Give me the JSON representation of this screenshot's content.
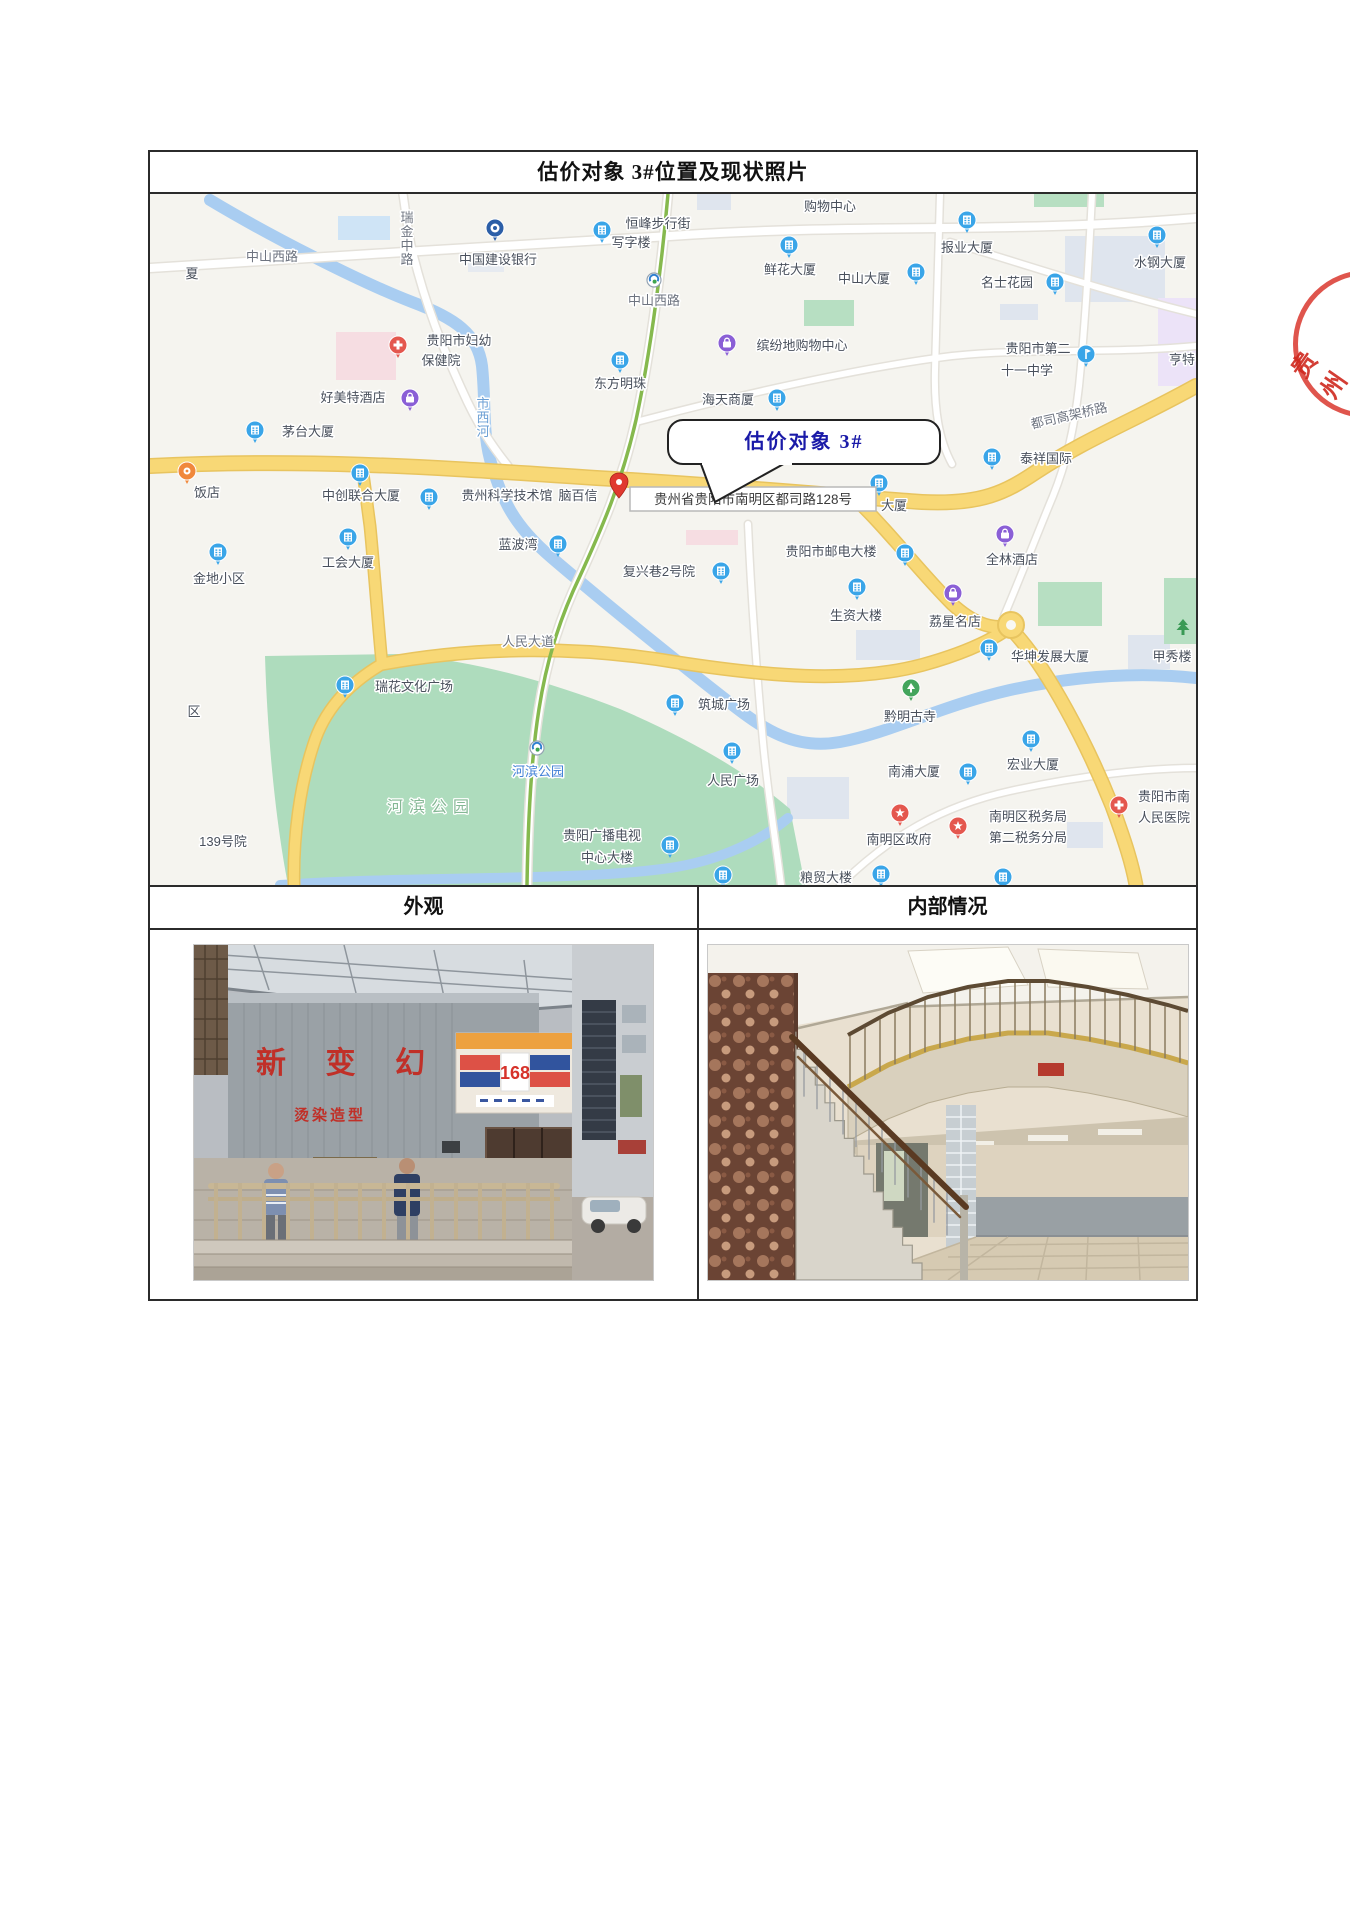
{
  "table": {
    "title": "估价对象 3#位置及现状照片",
    "left_header": "外观",
    "right_header": "内部情况"
  },
  "map": {
    "callout_text": "估价对象 3#",
    "address_tooltip": "贵州省贵阳市南明区都司路128号",
    "road_labels": [
      {
        "t": "中山西路",
        "x": 122,
        "y": 67,
        "cls": "road"
      },
      {
        "t": "瑞金中路",
        "x": 257,
        "y": 14,
        "cls": "road",
        "vertical": true
      },
      {
        "t": "市西河",
        "x": 333,
        "y": 200,
        "cls": "river",
        "vertical": true
      },
      {
        "t": "人民大道",
        "x": 378,
        "y": 452,
        "cls": "road"
      },
      {
        "t": "都司高架桥路",
        "x": 920,
        "y": 226,
        "cls": "road",
        "rot": -13
      },
      {
        "t": "河滨公园",
        "x": 281,
        "y": 618,
        "cls": "park"
      }
    ],
    "pois": [
      {
        "type": "bank",
        "ix": 345,
        "iy": 34,
        "lines": [
          {
            "t": "中国建设银行",
            "x": 348,
            "y": 70
          }
        ]
      },
      {
        "type": "building",
        "ix": 452,
        "iy": 36,
        "lines": [
          {
            "t": "恒峰步行街",
            "x": 508,
            "y": 34
          },
          {
            "t": "写字楼",
            "x": 481,
            "y": 53
          }
        ]
      },
      {
        "type": "none",
        "lines": [
          {
            "t": "购物中心",
            "x": 680,
            "y": 17
          }
        ]
      },
      {
        "type": "building",
        "ix": 639,
        "iy": 51,
        "lines": [
          {
            "t": "鲜花大厦",
            "x": 640,
            "y": 80
          }
        ]
      },
      {
        "type": "building",
        "ix": 817,
        "iy": 26,
        "lines": [
          {
            "t": "报业大厦",
            "x": 817,
            "y": 58
          }
        ]
      },
      {
        "type": "building",
        "ix": 1007,
        "iy": 41,
        "lines": [
          {
            "t": "水钢大厦",
            "x": 1010,
            "y": 73
          }
        ]
      },
      {
        "type": "building",
        "ix": 766,
        "iy": 78,
        "lines": [
          {
            "t": "中山大厦",
            "x": 714,
            "y": 89
          }
        ]
      },
      {
        "type": "building",
        "ix": 905,
        "iy": 88,
        "lines": [
          {
            "t": "名士花园",
            "x": 857,
            "y": 93
          }
        ]
      },
      {
        "type": "shopping",
        "ix": 577,
        "iy": 149,
        "lines": [
          {
            "t": "缤纷地购物中心",
            "x": 652,
            "y": 156
          }
        ]
      },
      {
        "type": "school",
        "ix": 936,
        "iy": 160,
        "lines": [
          {
            "t": "贵阳市第二",
            "x": 888,
            "y": 159
          },
          {
            "t": "十一中学",
            "x": 877,
            "y": 181
          }
        ]
      },
      {
        "type": "none",
        "lines": [
          {
            "t": "亨特",
            "x": 1032,
            "y": 170
          }
        ]
      },
      {
        "type": "building",
        "ix": 470,
        "iy": 166,
        "lines": [
          {
            "t": "东方明珠",
            "x": 470,
            "y": 194
          }
        ]
      },
      {
        "type": "hospital",
        "ix": 248,
        "iy": 151,
        "lines": [
          {
            "t": "贵阳市妇幼",
            "x": 309,
            "y": 151
          },
          {
            "t": "保健院",
            "x": 291,
            "y": 171
          }
        ]
      },
      {
        "type": "hotel",
        "ix": 260,
        "iy": 204,
        "lines": [
          {
            "t": "好美特酒店",
            "x": 203,
            "y": 208
          }
        ]
      },
      {
        "type": "building",
        "ix": 105,
        "iy": 236,
        "lines": [
          {
            "t": "茅台大厦",
            "x": 158,
            "y": 242
          }
        ]
      },
      {
        "type": "building",
        "ix": 627,
        "iy": 204,
        "lines": [
          {
            "t": "海天商厦",
            "x": 578,
            "y": 210
          }
        ]
      },
      {
        "type": "restaurant",
        "ix": 37,
        "iy": 277,
        "lines": [
          {
            "t": "饭店",
            "x": 57,
            "y": 303
          }
        ]
      },
      {
        "type": "building",
        "ix": 210,
        "iy": 279,
        "lines": [
          {
            "t": "中创联合大厦",
            "x": 211,
            "y": 306
          }
        ]
      },
      {
        "type": "building",
        "ix": 279,
        "iy": 303,
        "lines": [
          {
            "t": "贵州科学技术馆",
            "x": 357,
            "y": 306
          }
        ]
      },
      {
        "type": "none",
        "lines": [
          {
            "t": "脑百信",
            "x": 428,
            "y": 306
          }
        ]
      },
      {
        "type": "building",
        "ix": 729,
        "iy": 289,
        "lines": [
          {
            "t": "大厦",
            "x": 744,
            "y": 316
          }
        ]
      },
      {
        "type": "building",
        "ix": 842,
        "iy": 263,
        "lines": [
          {
            "t": "泰祥国际",
            "x": 896,
            "y": 269
          }
        ]
      },
      {
        "type": "building",
        "ix": 408,
        "iy": 350,
        "lines": [
          {
            "t": "蓝波湾",
            "x": 368,
            "y": 355
          }
        ]
      },
      {
        "type": "building",
        "ix": 198,
        "iy": 343,
        "lines": [
          {
            "t": "工会大厦",
            "x": 198,
            "y": 373
          }
        ]
      },
      {
        "type": "building",
        "ix": 68,
        "iy": 358,
        "lines": [
          {
            "t": "金地小区",
            "x": 69,
            "y": 389
          }
        ]
      },
      {
        "type": "building",
        "ix": 571,
        "iy": 377,
        "lines": [
          {
            "t": "复兴巷2号院",
            "x": 509,
            "y": 382
          }
        ]
      },
      {
        "type": "building",
        "ix": 755,
        "iy": 359,
        "lines": [
          {
            "t": "贵阳市邮电大楼",
            "x": 681,
            "y": 362
          }
        ]
      },
      {
        "type": "hotel",
        "ix": 855,
        "iy": 340,
        "lines": [
          {
            "t": "全林酒店",
            "x": 862,
            "y": 370
          }
        ]
      },
      {
        "type": "building",
        "ix": 707,
        "iy": 393,
        "lines": [
          {
            "t": "生资大楼",
            "x": 706,
            "y": 426
          }
        ]
      },
      {
        "type": "shopping",
        "ix": 803,
        "iy": 399,
        "lines": [
          {
            "t": "荔星名店",
            "x": 805,
            "y": 432
          }
        ]
      },
      {
        "type": "building",
        "ix": 839,
        "iy": 454,
        "lines": [
          {
            "t": "华坤发展大厦",
            "x": 900,
            "y": 467
          }
        ]
      },
      {
        "type": "landmark",
        "ix": 1033,
        "iy": 434,
        "lines": [
          {
            "t": "甲秀楼",
            "x": 1022,
            "y": 467,
            "anchor": "start"
          }
        ]
      },
      {
        "type": "building",
        "ix": 195,
        "iy": 491,
        "lines": [
          {
            "t": "瑞花文化广场",
            "x": 264,
            "y": 497
          }
        ]
      },
      {
        "type": "temple",
        "ix": 761,
        "iy": 494,
        "lines": [
          {
            "t": "黔明古寺",
            "x": 760,
            "y": 527
          }
        ]
      },
      {
        "type": "building",
        "ix": 525,
        "iy": 509,
        "lines": [
          {
            "t": "筑城广场",
            "x": 574,
            "y": 515
          }
        ]
      },
      {
        "type": "building",
        "ix": 582,
        "iy": 557,
        "lines": [
          {
            "t": "人民广场",
            "x": 583,
            "y": 591
          }
        ]
      },
      {
        "type": "metro",
        "ix": 387,
        "iy": 554,
        "lines": [
          {
            "t": "河滨公园",
            "x": 388,
            "y": 582,
            "cls": "station"
          }
        ]
      },
      {
        "type": "metro",
        "ix": 504,
        "iy": 86,
        "lines": [
          {
            "t": "中山西路",
            "x": 504,
            "y": 111,
            "cls": "road"
          }
        ]
      },
      {
        "type": "building",
        "ix": 818,
        "iy": 578,
        "lines": [
          {
            "t": "南浦大厦",
            "x": 764,
            "y": 582
          }
        ]
      },
      {
        "type": "building",
        "ix": 881,
        "iy": 545,
        "lines": [
          {
            "t": "宏业大厦",
            "x": 883,
            "y": 575
          }
        ]
      },
      {
        "type": "building",
        "ix": 520,
        "iy": 651,
        "lines": [
          {
            "t": "贵阳广播电视",
            "x": 452,
            "y": 646
          },
          {
            "t": "中心大楼",
            "x": 457,
            "y": 668
          }
        ]
      },
      {
        "type": "government",
        "ix": 750,
        "iy": 619,
        "lines": [
          {
            "t": "南明区政府",
            "x": 749,
            "y": 650
          }
        ]
      },
      {
        "type": "government",
        "ix": 808,
        "iy": 632,
        "lines": [
          {
            "t": "南明区税务局",
            "x": 878,
            "y": 627
          },
          {
            "t": "第二税务分局",
            "x": 878,
            "y": 648
          }
        ]
      },
      {
        "type": "hospital",
        "ix": 969,
        "iy": 611,
        "lines": [
          {
            "t": "贵阳市南",
            "x": 1014,
            "y": 607
          },
          {
            "t": "人民医院",
            "x": 1014,
            "y": 628
          }
        ]
      },
      {
        "type": "building",
        "ix": 731,
        "iy": 680,
        "lines": [
          {
            "t": "粮贸大楼",
            "x": 676,
            "y": 688
          }
        ]
      },
      {
        "type": "building",
        "ix": 573,
        "iy": 681,
        "lines": []
      },
      {
        "type": "building",
        "ix": 853,
        "iy": 683,
        "lines": []
      },
      {
        "type": "none",
        "lines": [
          {
            "t": "区",
            "x": 44,
            "y": 522
          }
        ]
      },
      {
        "type": "none",
        "lines": [
          {
            "t": "夏",
            "x": 42,
            "y": 84
          }
        ]
      },
      {
        "type": "none",
        "lines": [
          {
            "t": "139号院",
            "x": 73,
            "y": 652
          }
        ]
      }
    ],
    "poi_colors": {
      "building": "#3aa5e8",
      "school": "#3aa5e8",
      "bank": "#2b5ea7",
      "shopping": "#8a5fd6",
      "hotel": "#8a5fd6",
      "hospital": "#e4574e",
      "government": "#e4574e",
      "temple": "#43a55c",
      "restaurant": "#f0883c",
      "landmark": "#3a9a55"
    }
  },
  "photos": {
    "exterior": {
      "sign_large": "新 变 幻",
      "sign_small": "烫染造型",
      "sign_168": "168"
    },
    "interior": {}
  },
  "seal_text": "贵州"
}
